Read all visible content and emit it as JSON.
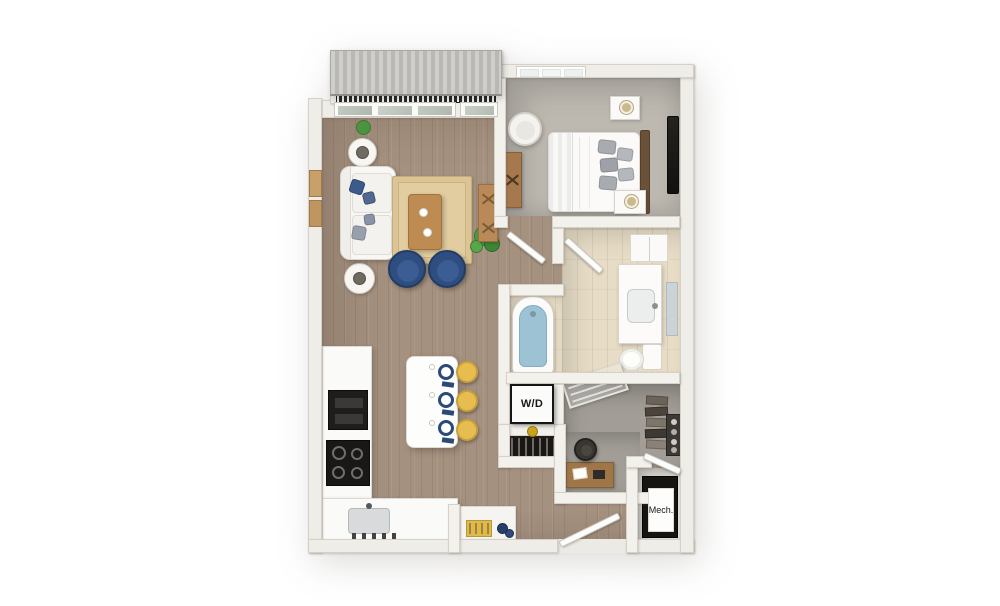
{
  "labels": {
    "washer_dryer": "W/D",
    "mechanical": "Mech."
  },
  "palette": {
    "background": "#ffffff",
    "wall": "#f3f1ec",
    "wood_floor": "#a5917f",
    "bedroom_carpet": "#bdb9b1",
    "bathroom_tile": "#e7ddc7",
    "closet_floor": "#a29e97",
    "tub_water": "#9cc2d4",
    "navy_accent": "#2e4d80",
    "stool_yellow": "#e8bd4f",
    "rug_tan": "#dbc496",
    "awning_roof": "#c4c3c0",
    "railing_dark": "#2b2a28",
    "plant_green": "#4c9340",
    "furniture_wood": "#b9854e",
    "headboard_brown": "#6a5138",
    "appliance_black": "#1e1d1b"
  }
}
